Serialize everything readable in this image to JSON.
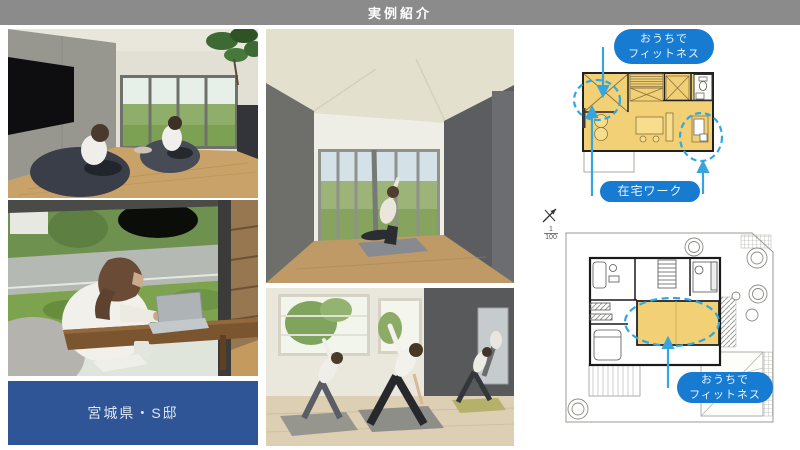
{
  "header": {
    "title": "実例紹介"
  },
  "gallery": {
    "location_label": "宮城県・S邸"
  },
  "plans": {
    "second_floor": {
      "callout_fitness": {
        "line1": "おうちで",
        "line2": "フィットネス"
      },
      "callout_work": {
        "label": "在宅ワーク"
      }
    },
    "first_floor": {
      "scale": {
        "numerator": "1",
        "denominator": "100"
      },
      "callout_fitness": {
        "line1": "おうちで",
        "line2": "フィットネス"
      }
    }
  },
  "colors": {
    "header_bg": "#8b8b8b",
    "location_label_bg": "#2f5597",
    "callout_bg": "#177bd1",
    "plan_highlight_yellow": "#f2d075",
    "annotation_blue": "#35a4e0"
  }
}
